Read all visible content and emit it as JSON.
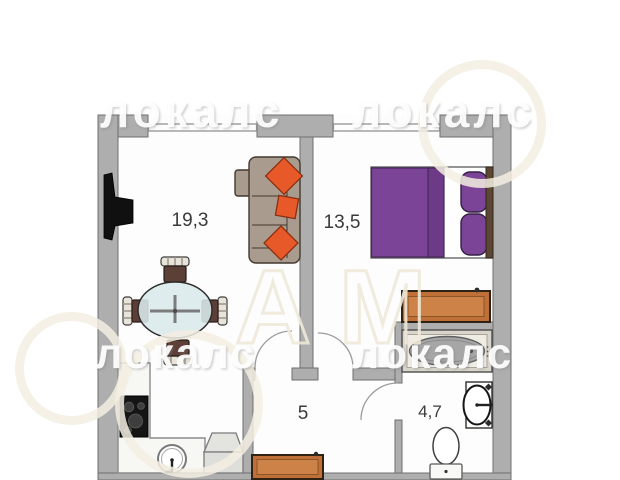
{
  "rooms": {
    "living": {
      "area_label": "19,3"
    },
    "bedroom": {
      "area_label": "13,5"
    },
    "hallway": {
      "area_label": "5"
    },
    "bathroom": {
      "area_label": "4,7"
    }
  },
  "watermark": {
    "brand_text": "локалс",
    "large_monogram": "АМ"
  },
  "colors": {
    "wall_gray": "#aeaeae",
    "bed_purple": "#7c4496",
    "bed_fold_purple": "#6c3a87",
    "wood_orange": "#bf7038",
    "wood_orange_light": "#cd8348",
    "cushion_orange": "#e8592a",
    "sofa_taupe": "#a99b8e",
    "tub_gray": "#a6a6a6"
  },
  "furniture_icons": [
    "tv",
    "corner-sofa",
    "throw-pillow",
    "dining-table",
    "dining-chair",
    "kitchen-counter",
    "stove",
    "kitchen-sink",
    "appliance-box",
    "double-bed",
    "bed-pillow",
    "dresser",
    "shoe-bench",
    "bathtub",
    "wash-basin",
    "toilet"
  ]
}
